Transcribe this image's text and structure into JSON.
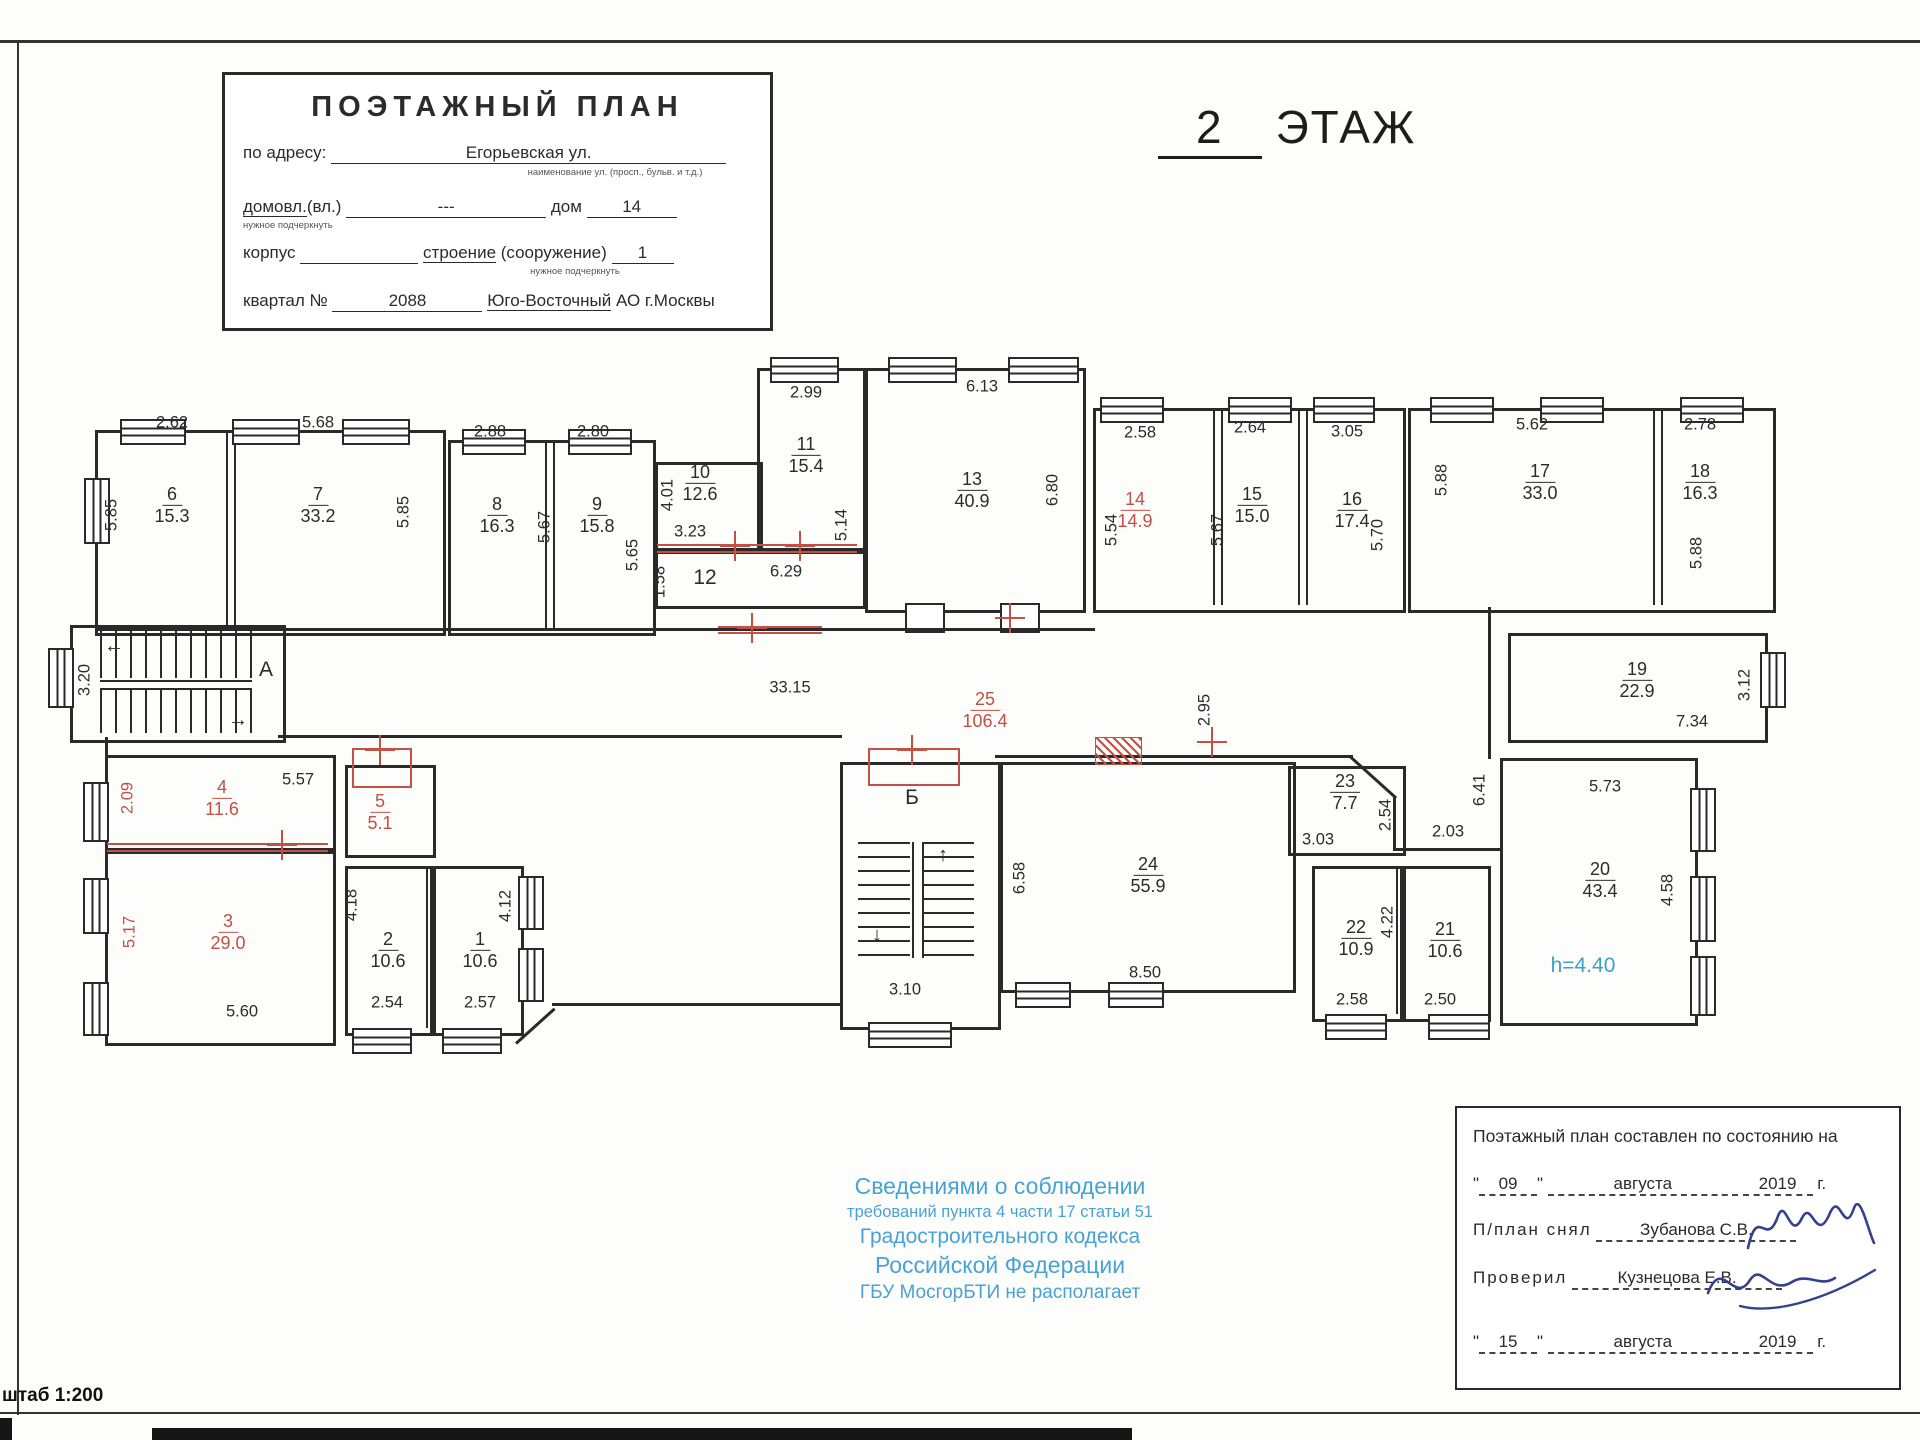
{
  "header": {
    "floor_number": "2",
    "floor_word": "ЭТАЖ"
  },
  "title_block": {
    "title": "ПОЭТАЖНЫЙ ПЛАН",
    "address_label": "по адресу:",
    "address_value": "Егорьевская ул.",
    "address_note": "наименование ул. (просп., бульв. и т.д.)",
    "ownership_label_u": "домовл.",
    "ownership_label_rest": "(вл.)",
    "ownership_value": "---",
    "ownership_note": "нужное подчеркнуть",
    "house_label": "дом",
    "house_value": "14",
    "korpus_label": "корпус",
    "stroenie_label_u": "строение",
    "stroenie_label_rest": " (сооружение)",
    "stroenie_note": "нужное подчеркнуть",
    "stroenie_value": "1",
    "kvartal_label": "квартал №",
    "kvartal_value": "2088",
    "district_u": "Юго-Восточный",
    "district_rest": " АО г.Москвы"
  },
  "plan": {
    "rooms": [
      {
        "num": "6",
        "area": "15.3",
        "x": 172,
        "y": 505
      },
      {
        "num": "7",
        "area": "33.2",
        "x": 318,
        "y": 505
      },
      {
        "num": "8",
        "area": "16.3",
        "x": 497,
        "y": 515
      },
      {
        "num": "9",
        "area": "15.8",
        "x": 597,
        "y": 515
      },
      {
        "num": "10",
        "area": "12.6",
        "x": 700,
        "y": 483
      },
      {
        "num": "11",
        "area": "15.4",
        "x": 806,
        "y": 455
      },
      {
        "num": "13",
        "area": "40.9",
        "x": 972,
        "y": 490
      },
      {
        "num": "14",
        "area": "14.9",
        "x": 1135,
        "y": 510,
        "red": true
      },
      {
        "num": "15",
        "area": "15.0",
        "x": 1252,
        "y": 505
      },
      {
        "num": "16",
        "area": "17.4",
        "x": 1352,
        "y": 510
      },
      {
        "num": "17",
        "area": "33.0",
        "x": 1540,
        "y": 482
      },
      {
        "num": "18",
        "area": "16.3",
        "x": 1700,
        "y": 482
      },
      {
        "num": "19",
        "area": "22.9",
        "x": 1637,
        "y": 680
      },
      {
        "num": "25",
        "area": "106.4",
        "x": 985,
        "y": 710,
        "red": true
      },
      {
        "num": "4",
        "area": "11.6",
        "x": 222,
        "y": 798,
        "red": true
      },
      {
        "num": "5",
        "area": "5.1",
        "x": 380,
        "y": 812,
        "red": true
      },
      {
        "num": "3",
        "area": "29.0",
        "x": 228,
        "y": 932,
        "red": true
      },
      {
        "num": "2",
        "area": "10.6",
        "x": 388,
        "y": 950
      },
      {
        "num": "1",
        "area": "10.6",
        "x": 480,
        "y": 950
      },
      {
        "num": "24",
        "area": "55.9",
        "x": 1148,
        "y": 875
      },
      {
        "num": "23",
        "area": "7.7",
        "x": 1345,
        "y": 792
      },
      {
        "num": "22",
        "area": "10.9",
        "x": 1356,
        "y": 938
      },
      {
        "num": "21",
        "area": "10.6",
        "x": 1445,
        "y": 940
      },
      {
        "num": "20",
        "area": "43.4",
        "x": 1600,
        "y": 880
      }
    ],
    "dims": [
      {
        "text": "2.62",
        "x": 172,
        "y": 423
      },
      {
        "text": "5.68",
        "x": 318,
        "y": 423
      },
      {
        "text": "2.88",
        "x": 490,
        "y": 432
      },
      {
        "text": "2.80",
        "x": 593,
        "y": 432
      },
      {
        "text": "2.99",
        "x": 806,
        "y": 393
      },
      {
        "text": "6.13",
        "x": 982,
        "y": 387
      },
      {
        "text": "3.23",
        "x": 690,
        "y": 532
      },
      {
        "text": "6.29",
        "x": 786,
        "y": 572
      },
      {
        "text": "2.58",
        "x": 1140,
        "y": 433
      },
      {
        "text": "2.64",
        "x": 1250,
        "y": 428
      },
      {
        "text": "3.05",
        "x": 1347,
        "y": 432
      },
      {
        "text": "5.62",
        "x": 1532,
        "y": 425
      },
      {
        "text": "2.78",
        "x": 1700,
        "y": 425
      },
      {
        "text": "33.15",
        "x": 790,
        "y": 688
      },
      {
        "text": "5.57",
        "x": 298,
        "y": 780
      },
      {
        "text": "5.60",
        "x": 242,
        "y": 1012
      },
      {
        "text": "2.54",
        "x": 387,
        "y": 1003
      },
      {
        "text": "2.57",
        "x": 480,
        "y": 1003
      },
      {
        "text": "3.10",
        "x": 905,
        "y": 990
      },
      {
        "text": "8.50",
        "x": 1145,
        "y": 973
      },
      {
        "text": "2.03",
        "x": 1448,
        "y": 832
      },
      {
        "text": "3.03",
        "x": 1318,
        "y": 840
      },
      {
        "text": "2.58",
        "x": 1352,
        "y": 1000
      },
      {
        "text": "2.50",
        "x": 1440,
        "y": 1000
      },
      {
        "text": "5.73",
        "x": 1605,
        "y": 787
      },
      {
        "text": "7.34",
        "x": 1692,
        "y": 722
      },
      {
        "text": "5.85",
        "x": 112,
        "y": 515,
        "v": true
      },
      {
        "text": "5.85",
        "x": 404,
        "y": 512,
        "v": true
      },
      {
        "text": "5.67",
        "x": 545,
        "y": 527,
        "v": true
      },
      {
        "text": "5.65",
        "x": 633,
        "y": 555,
        "v": true
      },
      {
        "text": "4.01",
        "x": 668,
        "y": 495,
        "v": true
      },
      {
        "text": "1.58",
        "x": 660,
        "y": 582,
        "v": true
      },
      {
        "text": "5.14",
        "x": 842,
        "y": 525,
        "v": true
      },
      {
        "text": "6.80",
        "x": 1053,
        "y": 490,
        "v": true
      },
      {
        "text": "5.54",
        "x": 1112,
        "y": 530,
        "v": true
      },
      {
        "text": "5.67",
        "x": 1218,
        "y": 530,
        "v": true
      },
      {
        "text": "5.70",
        "x": 1378,
        "y": 535,
        "v": true
      },
      {
        "text": "5.88",
        "x": 1442,
        "y": 480,
        "v": true
      },
      {
        "text": "5.88",
        "x": 1697,
        "y": 553,
        "v": true
      },
      {
        "text": "3.20",
        "x": 85,
        "y": 680,
        "v": true
      },
      {
        "text": "2.95",
        "x": 1205,
        "y": 710,
        "v": true
      },
      {
        "text": "6.41",
        "x": 1480,
        "y": 790,
        "v": true
      },
      {
        "text": "3.12",
        "x": 1745,
        "y": 685,
        "v": true
      },
      {
        "text": "2.09",
        "x": 128,
        "y": 798,
        "v": true,
        "red": true
      },
      {
        "text": "5.17",
        "x": 130,
        "y": 932,
        "v": true,
        "red": true
      },
      {
        "text": "4.18",
        "x": 352,
        "y": 905,
        "v": true
      },
      {
        "text": "4.12",
        "x": 506,
        "y": 906,
        "v": true
      },
      {
        "text": "2.54",
        "x": 1386,
        "y": 815,
        "v": true
      },
      {
        "text": "4.22",
        "x": 1388,
        "y": 922,
        "v": true
      },
      {
        "text": "4.58",
        "x": 1668,
        "y": 890,
        "v": true
      },
      {
        "text": "6.58",
        "x": 1020,
        "y": 878,
        "v": true
      }
    ],
    "marks": [
      {
        "text": "12",
        "x": 705,
        "y": 578
      },
      {
        "text": "А",
        "x": 266,
        "y": 670
      },
      {
        "text": "Б",
        "x": 912,
        "y": 798
      },
      {
        "text": "h=4.40",
        "x": 1583,
        "y": 966,
        "blue": true
      }
    ]
  },
  "disclaimer": {
    "line1": "Сведениями о соблюдении",
    "line2": "требований пункта 4 части 17 статьи 51",
    "line3": "Градостроительного кодекса",
    "line4": "Российской Федерации",
    "line5": "ГБУ МосгорБТИ не располагает"
  },
  "stamp": {
    "line1": "Поэтажный план составлен по состоянию на",
    "quote": "\"",
    "date1_day": "09",
    "date1_month": "августа",
    "date1_year": "2019",
    "year_suffix": "г.",
    "surveyor_label": "П/план снял",
    "surveyor_name": "Зубанова С.В.",
    "checker_label": "Проверил",
    "checker_name": "Кузнецова Е.В.",
    "date2_day": "15",
    "date2_month": "августа",
    "date2_year": "2019"
  },
  "scale_note": "штаб 1:200"
}
